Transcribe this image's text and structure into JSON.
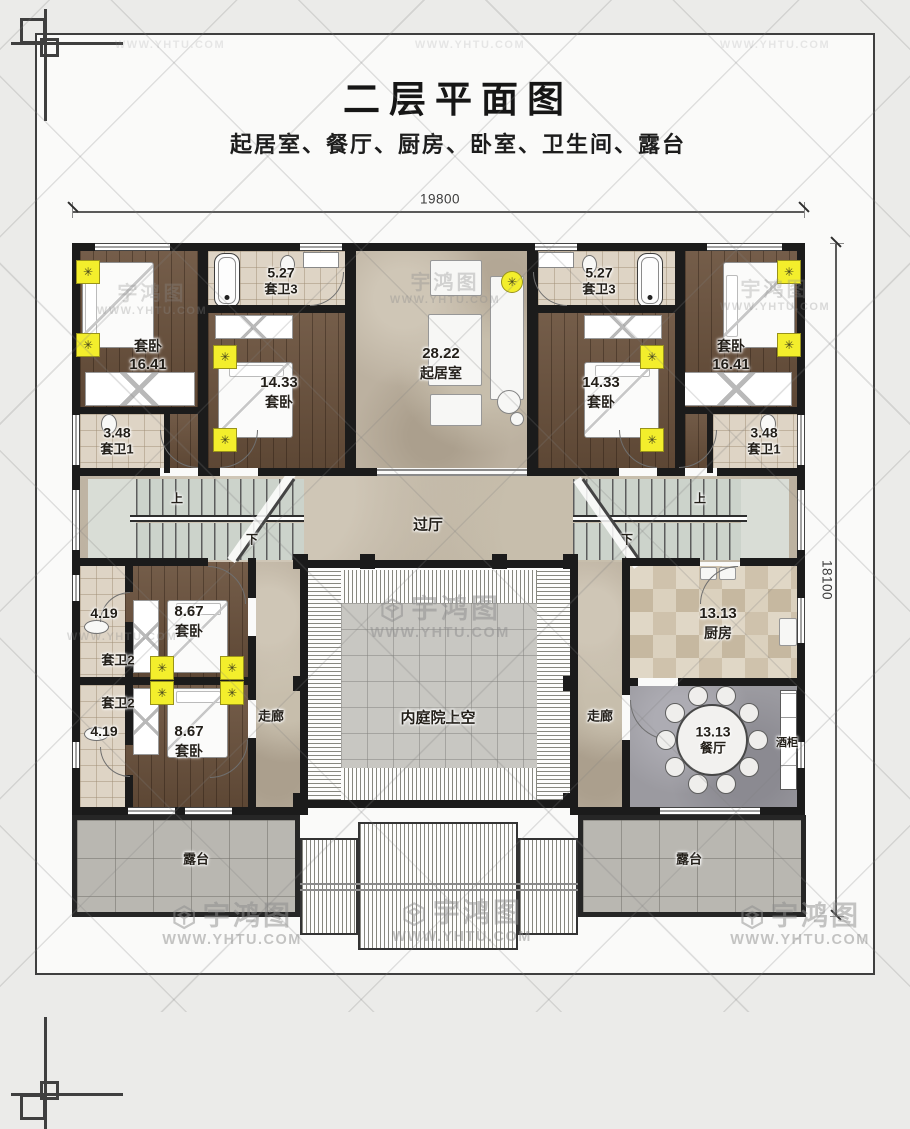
{
  "page": {
    "title": "二层平面图",
    "subtitle": "起居室、餐厅、厨房、卧室、卫生间、露台"
  },
  "watermark": {
    "logo": "宇鸿图",
    "url": "WWW.YHTU.COM"
  },
  "dimensions": {
    "width_mm": "19800",
    "height_mm": "18100"
  },
  "icons": {
    "light_glyph": "✳"
  },
  "rooms": {
    "living": {
      "area": "28.22",
      "name": "起居室"
    },
    "hall": {
      "name": "过厅"
    },
    "courtyard": {
      "name": "内庭院上空"
    },
    "kitchen": {
      "area": "13.13",
      "name": "厨房"
    },
    "dining": {
      "area": "13.13",
      "name": "餐厅"
    },
    "wine_cabinet": {
      "name": "酒柜"
    },
    "corridor": {
      "name": "走廊"
    },
    "terrace": {
      "name": "露台"
    },
    "stairs": {
      "up": "上",
      "down": "下"
    },
    "suite_bed_large": {
      "name": "套卧",
      "area": "16.41"
    },
    "suite_bed_mid": {
      "name": "套卧",
      "area": "14.33"
    },
    "suite_bed_small": {
      "name": "套卧",
      "area": "8.67"
    },
    "suite_bath1": {
      "name": "套卫1",
      "area": "3.48"
    },
    "suite_bath2": {
      "name": "套卫2",
      "area": "4.19"
    },
    "suite_bath3": {
      "name": "套卫3",
      "area": "5.27"
    }
  }
}
